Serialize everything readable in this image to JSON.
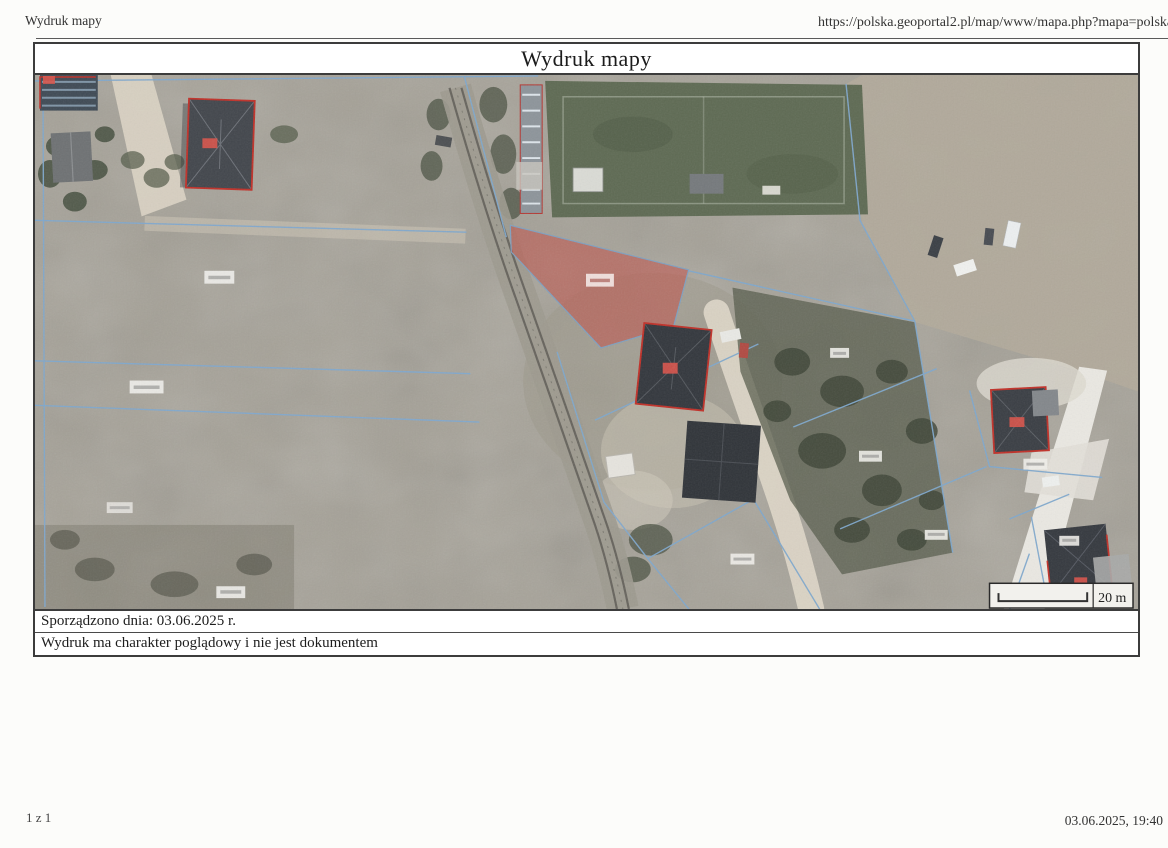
{
  "page": {
    "header": {
      "title_left": "Wydruk mapy",
      "url_right": "https://polska.geoportal2.pl/map/www/mapa.php?mapa=polska"
    },
    "footer": {
      "page_indicator": "1 z 1",
      "datetime": "03.06.2025, 19:40"
    }
  },
  "map": {
    "title": "Wydruk mapy",
    "scale_label": "20 m",
    "notes": [
      "Sporządzono dnia: 03.06.2025 r.",
      "Wydruk ma charakter poglądowy i nie jest dokumentem"
    ],
    "legend": {
      "highlighted_parcel_color": "#c0524a",
      "parcel_boundary_color": "#7fa8cd",
      "building_outline_color": "#c03028"
    },
    "features": [
      "aerial-orthophoto-background",
      "railway-line",
      "soccer-field",
      "highlighted-red-parcel",
      "cadastral-parcel-boundaries",
      "buildings-with-red-outlines",
      "dirt-roads",
      "scale-bar"
    ]
  }
}
